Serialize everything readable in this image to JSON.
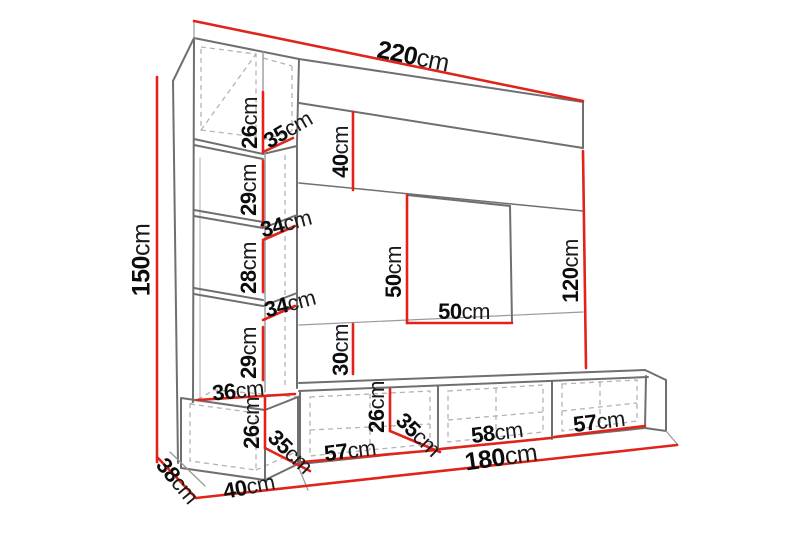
{
  "figure": {
    "kind": "furniture dimension diagram",
    "subject": "wall unit with tall side column, top shelf band, 50x50 niche panel and 3-door TV bench",
    "unit": "cm"
  },
  "colors": {
    "dimension_line": "#e2231a",
    "outline": "#6f6f6f",
    "dashed_guide": "#b3b3b3",
    "label_text": "#0c0c0c",
    "background": "#ffffff"
  },
  "summary": {
    "total_width": "220cm",
    "total_height": "150cm",
    "bench_width": "180cm",
    "panel_height_right": "120cm",
    "base_depth_left": "38cm"
  },
  "labels": {
    "d220": {
      "value": "220",
      "unit": "cm"
    },
    "d150": {
      "value": "150",
      "unit": "cm"
    },
    "d26a": {
      "value": "26",
      "unit": "cm"
    },
    "d35a": {
      "value": "35",
      "unit": "cm"
    },
    "d40a": {
      "value": "40",
      "unit": "cm"
    },
    "d29a": {
      "value": "29",
      "unit": "cm"
    },
    "d34a": {
      "value": "34",
      "unit": "cm"
    },
    "d28": {
      "value": "28",
      "unit": "cm"
    },
    "d34b": {
      "value": "34",
      "unit": "cm"
    },
    "d29b": {
      "value": "29",
      "unit": "cm"
    },
    "d30": {
      "value": "30",
      "unit": "cm"
    },
    "d50v": {
      "value": "50",
      "unit": "cm"
    },
    "d50h": {
      "value": "50",
      "unit": "cm"
    },
    "d120": {
      "value": "120",
      "unit": "cm"
    },
    "d36": {
      "value": "36",
      "unit": "cm"
    },
    "d26b": {
      "value": "26",
      "unit": "cm"
    },
    "d35b": {
      "value": "35",
      "unit": "cm"
    },
    "d38": {
      "value": "38",
      "unit": "cm"
    },
    "d40b": {
      "value": "40",
      "unit": "cm"
    },
    "d26c": {
      "value": "26",
      "unit": "cm"
    },
    "d35c": {
      "value": "35",
      "unit": "cm"
    },
    "d57a": {
      "value": "57",
      "unit": "cm"
    },
    "d58": {
      "value": "58",
      "unit": "cm"
    },
    "d57b": {
      "value": "57",
      "unit": "cm"
    },
    "d180": {
      "value": "180",
      "unit": "cm"
    }
  }
}
